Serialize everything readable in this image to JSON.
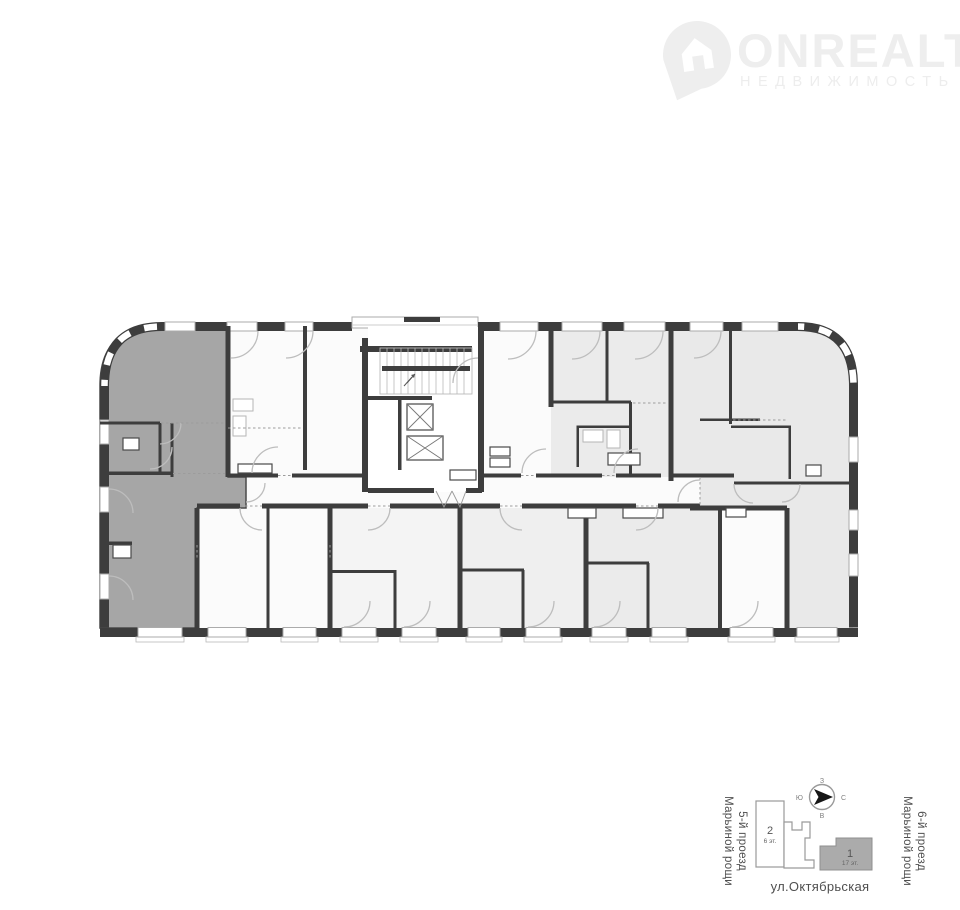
{
  "logo": {
    "brand": "ONREALT",
    "subtitle": "НЕДВИЖИМОСТЬ",
    "icon": "house-pin-icon",
    "color": "#eeeeee"
  },
  "colors": {
    "wall": "#3d3d3d",
    "highlight_apartment": "#a6a6a6",
    "light_room": "#e9e9e9",
    "light_room_mid": "#ebebeb",
    "lighter_room": "#f1f1f1",
    "corridor": "#ffffff",
    "door_arc": "#bdbdbd",
    "map_outline": "#9a9a9a",
    "map_building_fill": "#ababab",
    "map_text": "#4f4f4f"
  },
  "floor_plan": {
    "kind": "apartment-building floor plan",
    "highlighted_unit": "left-wing apartment (dark gray)",
    "core": "staircase and two elevators in central core",
    "corridor": "central horizontal corridor"
  },
  "minimap": {
    "street_left": {
      "line1": "5-й проезд",
      "line2": "Марьиной рощи"
    },
    "street_right": {
      "line1": "6-й проезд",
      "line2": "Марьиной рощи"
    },
    "street_bottom": "ул.Октябрьская",
    "building_1": {
      "number": "1",
      "floors": "17 эт."
    },
    "building_2": {
      "number": "2",
      "floors": "6 эт."
    },
    "compass": {
      "north": "С",
      "south": "Ю",
      "west": "З",
      "east": "В"
    }
  }
}
